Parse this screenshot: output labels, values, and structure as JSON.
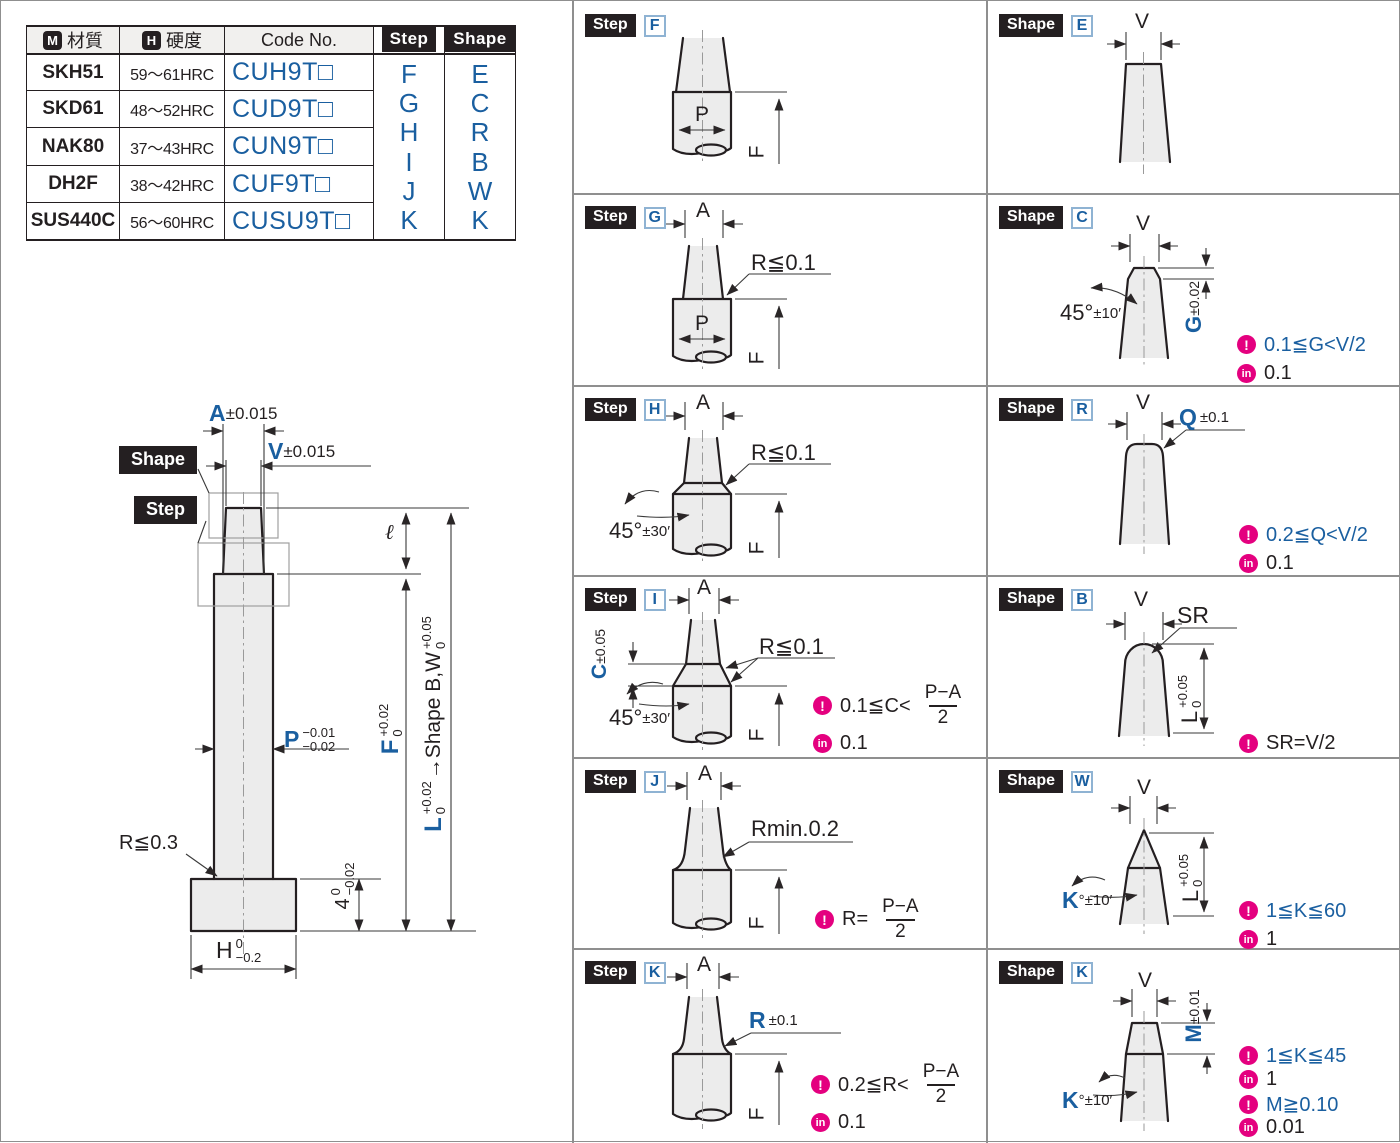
{
  "colors": {
    "accent_blue": "#1a5fa0",
    "magenta": "#e4007f",
    "part_fill": "#ececec"
  },
  "icons": {
    "caution": "!",
    "increment": "in"
  },
  "table": {
    "header": {
      "material_icon": "M",
      "material": "材質",
      "hardness_icon": "H",
      "hardness": "硬度",
      "code": "Code No.",
      "step": "Step",
      "shape": "Shape"
    },
    "rows": [
      {
        "material": "SKH51",
        "hardness": "59〜61HRC",
        "code": "CUH9T□"
      },
      {
        "material": "SKD61",
        "hardness": "48〜52HRC",
        "code": "CUD9T□"
      },
      {
        "material": "NAK80",
        "hardness": "37〜43HRC",
        "code": "CUN9T□"
      },
      {
        "material": "DH2F",
        "hardness": "38〜42HRC",
        "code": "CUF9T□"
      },
      {
        "material": "SUS440C",
        "hardness": "56〜60HRC",
        "code": "CUSU9T□"
      }
    ],
    "step_letters": [
      "F",
      "G",
      "H",
      "I",
      "J",
      "K"
    ],
    "shape_letters": [
      "E",
      "C",
      "R",
      "B",
      "W",
      "K"
    ]
  },
  "drawing": {
    "shape_tag": "Shape",
    "step_tag": "Step",
    "dim_a": "A",
    "dim_a_tol": "±0.015",
    "dim_v": "V",
    "dim_v_tol": "±0.015",
    "ell": "ℓ",
    "p": "P",
    "p_tol_top": "−0.01",
    "p_tol_bot": "−0.02",
    "f": "F",
    "f_tol_top": "+0.02",
    "f_tol_bot": "0",
    "l": "L",
    "l_tol_top": "+0.02",
    "l_tol_bot": "0",
    "l_suffix": "→Shape B,W",
    "bw_tol_top": "+0.05",
    "bw_tol_bot": "0",
    "r_max": "R≦0.3",
    "flange_t": "4",
    "flange_tol_top": "0",
    "flange_tol_bot": "−0.02",
    "h": "H",
    "h_tol_top": "0",
    "h_tol_bot": "−0.2"
  },
  "panels": {
    "step_f": {
      "tag": "Step",
      "letter": "F",
      "p": "P",
      "f": "F"
    },
    "step_g": {
      "tag": "Step",
      "letter": "G",
      "a": "A",
      "r": "R≦0.1",
      "p": "P",
      "f": "F"
    },
    "step_h": {
      "tag": "Step",
      "letter": "H",
      "a": "A",
      "r": "R≦0.1",
      "angle": "45°",
      "angle_tol": "±30′",
      "f": "F"
    },
    "step_i": {
      "tag": "Step",
      "letter": "I",
      "a": "A",
      "r": "R≦0.1",
      "angle": "45°",
      "angle_tol": "±30′",
      "c": "C",
      "c_tol": "±0.05",
      "f": "F",
      "note1_pre": "0.1≦C<",
      "note1_num": "P−A",
      "note1_den": "2",
      "note2": "0.1"
    },
    "step_j": {
      "tag": "Step",
      "letter": "J",
      "a": "A",
      "r": "Rmin.0.2",
      "f": "F",
      "note1_pre": "R=",
      "note1_num": "P−A",
      "note1_den": "2"
    },
    "step_k": {
      "tag": "Step",
      "letter": "K",
      "a": "A",
      "r_letter": "R",
      "r_tol": "±0.1",
      "f": "F",
      "note1_pre": "0.2≦R<",
      "note1_num": "P−A",
      "note1_den": "2",
      "note2": "0.1"
    },
    "shape_e": {
      "tag": "Shape",
      "letter": "E",
      "v": "V"
    },
    "shape_c": {
      "tag": "Shape",
      "letter": "C",
      "v": "V",
      "angle": "45°",
      "angle_tol": "±10′",
      "g": "G",
      "g_tol": "±0.02",
      "note1": "0.1≦G<V/2",
      "note2": "0.1"
    },
    "shape_r": {
      "tag": "Shape",
      "letter": "R",
      "v": "V",
      "q": "Q",
      "q_tol": "±0.1",
      "note1": "0.2≦Q<V/2",
      "note2": "0.1"
    },
    "shape_b": {
      "tag": "Shape",
      "letter": "B",
      "v": "V",
      "sr": "SR",
      "l": "L",
      "l_tol_top": "+0.05",
      "l_tol_bot": "0",
      "note1": "SR=V/2"
    },
    "shape_w": {
      "tag": "Shape",
      "letter": "W",
      "v": "V",
      "k": "K",
      "k_tol": "°±10′",
      "l": "L",
      "l_tol_top": "+0.05",
      "l_tol_bot": "0",
      "note1": "1≦K≦60",
      "note2": "1"
    },
    "shape_k": {
      "tag": "Shape",
      "letter": "K",
      "v": "V",
      "k": "K",
      "k_tol": "°±10′",
      "m": "M",
      "m_tol": "±0.01",
      "note1": "1≦K≦45",
      "note2": "1",
      "note3": "M≧0.10",
      "note4": "0.01"
    }
  }
}
